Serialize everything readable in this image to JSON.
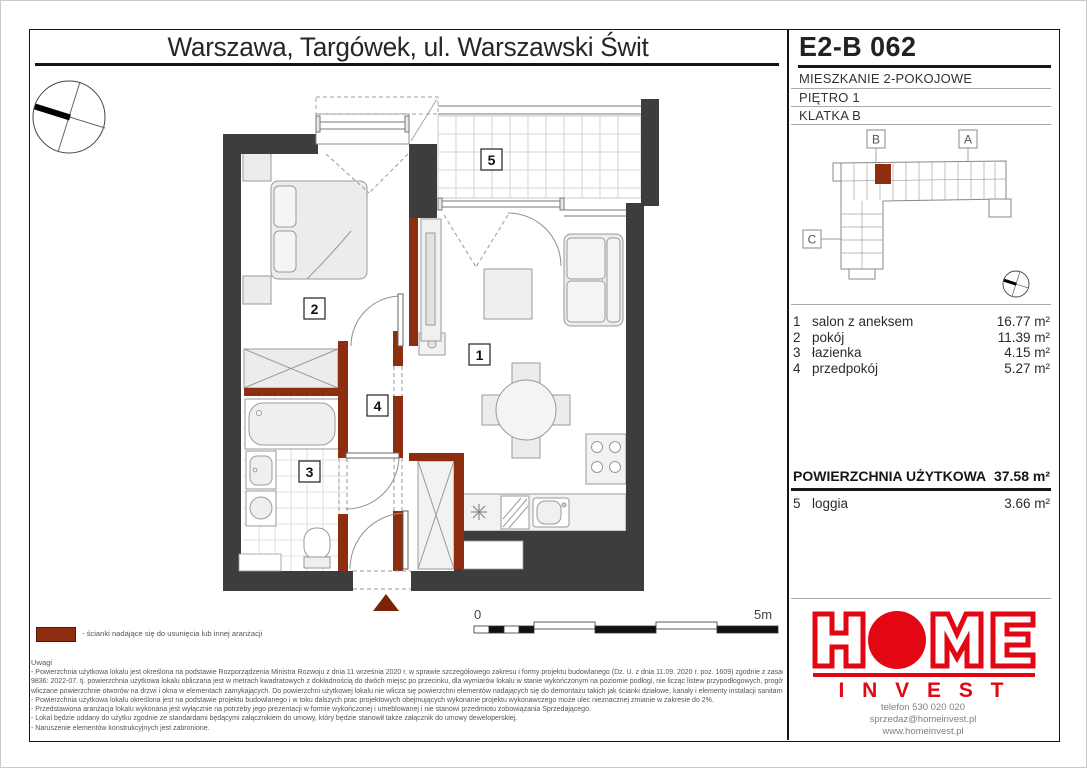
{
  "header": {
    "title": "Warszawa, Targówek, ul. Warszawski Świt"
  },
  "unit": {
    "code": "E2-B 062",
    "type": "MIESZKANIE 2-POKOJOWE",
    "floor": "PIĘTRO 1",
    "staircase": "KLATKA B"
  },
  "locator": {
    "marker_b": "B",
    "marker_a": "A",
    "marker_c": "C"
  },
  "rooms": [
    {
      "no": "1",
      "name": "salon z aneksem",
      "area": "16.77 m²"
    },
    {
      "no": "2",
      "name": "pokój",
      "area": "11.39 m²"
    },
    {
      "no": "3",
      "name": "łazienka",
      "area": "4.15 m²"
    },
    {
      "no": "4",
      "name": "przedpokój",
      "area": "5.27 m²"
    }
  ],
  "total": {
    "label": "POWIERZCHNIA UŻYTKOWA",
    "area": "37.58 m²"
  },
  "extra": {
    "no": "5",
    "name": "loggia",
    "area": "3.66 m²"
  },
  "plan": {
    "labels": {
      "r1": "1",
      "r2": "2",
      "r3": "3",
      "r4": "4",
      "r5": "5"
    },
    "scale_start": "0",
    "scale_end": "5m"
  },
  "legend": {
    "text": "- ścianki nadające się do usunięcia lub innej aranżacji"
  },
  "notes": {
    "heading": "Uwagi",
    "lines": [
      "- Powierzchnia użytkowa lokalu jest określona na podstawie Rozporządzenia Ministra Rozwoju z dnia 11 września 2020 r. w sprawie szczegółowego zakresu i formy projektu budowlanego (Dz. U. z dnia 11.09. 2020 r. poz. 1609) zgodnie z zasadami zawartymi w Polskiej Normie PN-ISO",
      "9836: 2022-07. tj. powierzchnia użytkowa lokalu obliczana jest w metrach kwadratowych z dokładnością do dwóch miejsc po przecinku, dla wymiarów lokalu w stanie wykończonym na poziomie podłogi, nie licząc listew przypodłogowych, progów itp. Do powierzchni użytkowej lokalu nie są",
      "wliczane powierzchnie otworów na drzwi i okna w elementach zamykających. Do powierzchni użytkowej lokalu nie wlicza się powierzchni elementów nadających się  do demontażu takich jak ścianki działowe,  kanały i elementy instalacji  sanitarnych.",
      "- Powierzchnia użytkowa lokalu określona jest na podstawie projektu budowlanego i w toku dalszych prac projektowych obejmujących wykonanie projektu wykonawczego może ulec nieznacznej zmianie w zakresie do 2%.",
      "- Przedstawiona aranżacja lokalu wykonana jest wyłącznie na potrzeby jego prezentacji w formie wykończonej i umeblowanej i nie stanowi przedmiotu zobowiązania Sprzedającego.",
      "- Lokal będzie oddany do użytku zgodnie ze standardami będącymi załącznikiem do umowy, który będzie stanowił także załącznik do umowy deweloperskiej.",
      "- Naruszenie elementów konstrukcyjnych jest zabronione."
    ]
  },
  "brand": {
    "home": "HOME",
    "invest": "I N V E S T",
    "phone": "telefon 530 020 020",
    "email": "sprzedaz@homeinvest.pl",
    "website": "www.homeinvest.pl"
  },
  "colors": {
    "accent_red": "#e30613",
    "wall_dark": "#3d3d3d",
    "removable_wall_brown": "#8c2e0f"
  }
}
